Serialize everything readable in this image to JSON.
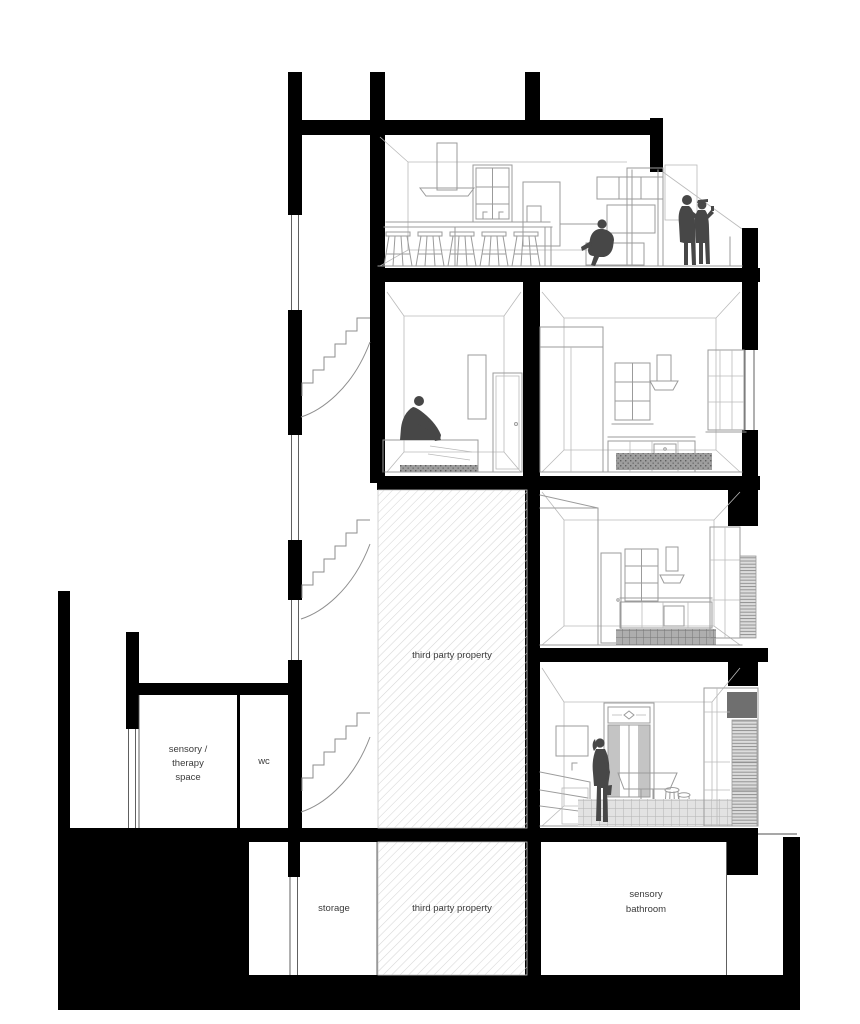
{
  "drawing": {
    "labels": {
      "third_party_property": "third party property",
      "storage": "storage",
      "wc": "wc",
      "sensory_therapy": [
        "sensory /",
        "therapy",
        "space"
      ],
      "sensory_bathroom": [
        "sensory",
        "bathroom"
      ]
    },
    "colors": {
      "wall": "#000000",
      "figure": "#474747",
      "line": "#9b9b9b",
      "line_light": "#bababa",
      "hatch": "#d6d6d6",
      "label": "#3a3a3a",
      "background": "#ffffff"
    }
  }
}
